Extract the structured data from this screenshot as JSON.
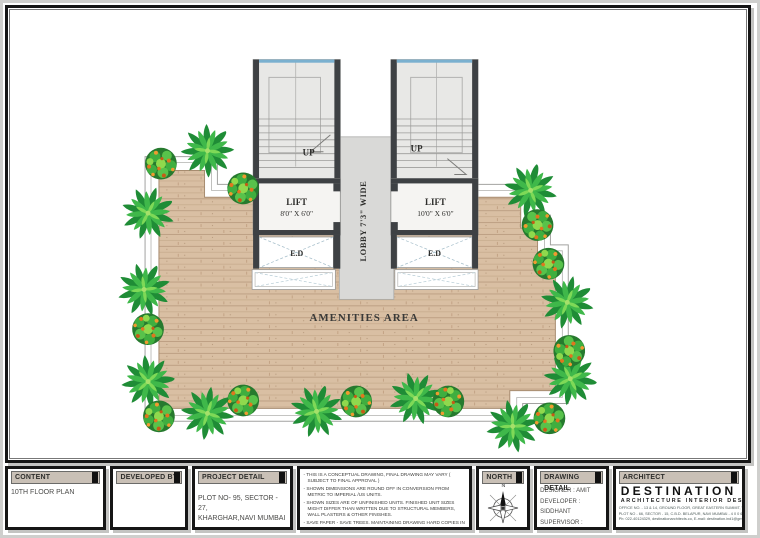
{
  "plan": {
    "stair_left_up": "UP",
    "stair_right_up": "UP",
    "lobby_label": "LOBBY 7'3\" WIDE",
    "lift_left_name": "LIFT",
    "lift_left_size": "8'0\" X 6'0\"",
    "lift_right_name": "LIFT",
    "lift_right_size": "10'0\" X 6'0\"",
    "ed_left": "E.D",
    "ed_right": "E.D",
    "amenities_label": "AMENITIES AREA"
  },
  "titleblock": {
    "content": {
      "header": "CONTENT",
      "value": "10TH FLOOR PLAN"
    },
    "developed_by": {
      "header": "DEVELOPED BY"
    },
    "project_detail": {
      "header": "PROJECT DETAIL",
      "line1": "PLOT NO- 95, SECTOR - 27,",
      "line2": "KHARGHAR,NAVI MUMBAI"
    },
    "notes": [
      "- THIS IS A CONCEPTUAL DRAWING, FINAL DRAWING MAY VARY ( SUBJECT TO FINAL APPROVAL )",
      "- SHOWN DIMENSIONS ARE ROUND OFF IN CONVERSION FROM METRIC TO IMPERIAL /US UNITS.",
      "- SHOWN SIZES ARE OF UNFINISHED UNITS. FINISHED UNIT SIZES MIGHT DIFFER THAN WRITTEN DUE TO STRUCTURAL MEMBERS, WALL PLASTERS & OTHER FINISHES.",
      "- SAVE PAPER - SAVE TREES. MAINTAINING DRAWING HARD COPIES IN GOOD CONDITION IS BEARER'S RESPONSIBILITY.",
      "- COPYRIGHTS OF CONTENT, CONCEPT AND FORMAT OF THIS DRAWING REMAIN RESERVED WITH DESTINATION Architecture Interior Designs."
    ],
    "north": {
      "header": "NORTH",
      "letter": "N"
    },
    "drawing_detail": {
      "header": "DRAWING DETAIL",
      "designer": "DESIGNER : AMIT",
      "developer": "DEVELOPER : SIDDHANT",
      "supervisor": "SUPERVISOR :",
      "date": "DATE : 10 - 02 - 2023"
    },
    "architect": {
      "header": "ARCHITECT",
      "brand": "DESTINATION",
      "tagline": "ARCHITECTURE INTERIOR DESIGNS",
      "address1": "OFFICE NO. - 13 & 14, GROUND FLOOR, GREAT EASTERN SUMMIT, WING-B",
      "address2": "PLOT NO - 66, SECTOR - 15, C.B.D. BELAPUR, NAVI MUMBAI - 4 0 0 6 1 4",
      "address3": "Ph: 022-40124329, destinationarchitects.co, E-mail: destination.ind1@gmail.com"
    }
  },
  "colors": {
    "wall": "#3e4144",
    "wood": "#d9bfa3",
    "window_blue": "#7ab0cf",
    "palm_green": "#2f9e3e",
    "fruit_orange": "#e0761f",
    "header_bar": "#c9c0b6",
    "logo_teal": "#0e5e6f"
  }
}
